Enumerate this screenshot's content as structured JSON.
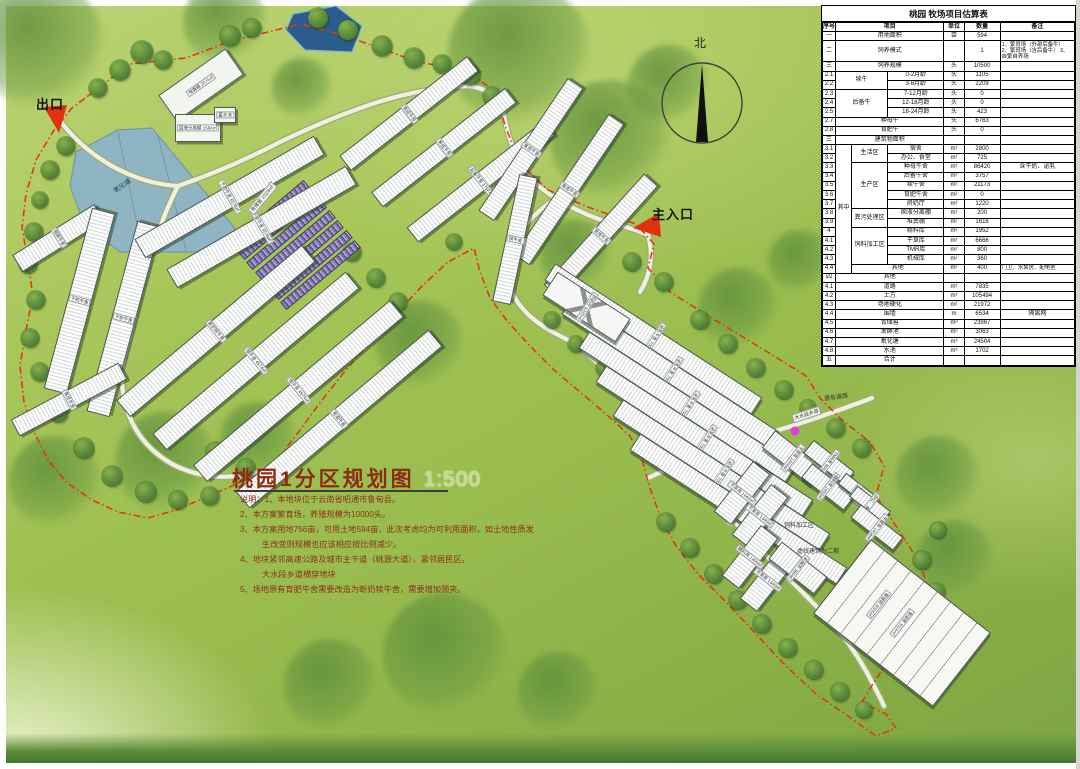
{
  "map": {
    "title": "桃园1分区规划图",
    "scale": "1:500",
    "north": "北",
    "exit": "出口",
    "entrance": "主入口",
    "existing_road": "原有道路",
    "road_name": "大水段乡道",
    "phase2_note": "虚线建筑为二期",
    "feed_zone": "饲料加工区",
    "pond": "氧化塘",
    "silage_tag": "青储窖 2324㎡",
    "notes": [
      "说明：1、本地块位于云南省昭通市鲁甸县。",
      "2、本方案繁育场，养殖规模为10000头。",
      "3、本方案用地756亩，可用土地594亩，此次考虑均为可利用面积，如土地性质发",
      "生改变则规模也应该相应按比例减少。",
      "4、地块紧邻高速公路及城市主干道（桃源大道），紧邻居民区。",
      "大水段乡道横穿地块",
      "5、场地原有育肥牛舍需要改造为断奶犊牛舍，需要增加颈夹。"
    ]
  },
  "buildings": [
    "隔离牛舍",
    "干奶牛舍",
    "干奶牛舍",
    "断奶犊牛舍",
    "犊牛舍 4574㎡",
    "犊牛舍 4574㎡",
    "育成牛舍",
    "干奶牛舍 6576㎡",
    "干奶牛舍 6576㎡",
    "育成牛舍",
    "育成牛舍",
    "育成牛舍",
    "后备牛舍 3757㎡",
    "育成牛舍",
    "育成牛舍",
    "犊牛舍",
    "育成牛舍",
    "泌乳牛舍 7004㎡",
    "泌乳牛舍 7004㎡",
    "泌乳牛舍 7004㎡",
    "泌乳牛舍 7004㎡",
    "泌乳牛舍 7004㎡",
    "泌乳牛舍 7004㎡",
    "挤奶厅 1220㎡",
    "干草库 1404㎡",
    "TMR库 800㎡",
    "精料库 1952㎡",
    "宿舍",
    "办公、食堂",
    "干草库 1404㎡",
    "干草库 1440㎡",
    "干草库 1440㎡",
    "精料库 1400㎡",
    "干草库 1440㎡",
    "机械库 360㎡",
    "堆粪棚 2574㎡",
    "固液分离棚 1584㎡",
    "蓄水池",
    "青储窖 3024㎡"
  ],
  "table": {
    "title": "桃园 牧场项目估算表",
    "rows": [
      {
        "cls": "hd",
        "c": [
          [
            "序号"
          ],
          [
            "项目",
            3
          ],
          [
            "单位"
          ],
          [
            "数量"
          ],
          [
            "备注"
          ]
        ]
      },
      {
        "c": [
          [
            "一"
          ],
          [
            "用地面积",
            3
          ],
          [
            "亩"
          ],
          [
            "594"
          ],
          [
            ""
          ]
        ]
      },
      {
        "cls": "tall",
        "c": [
          [
            "二"
          ],
          [
            "饲养模式",
            3
          ],
          [
            ""
          ],
          [
            "1"
          ],
          [
            "1、繁育场（外部后备牛） 2、繁育场（含后备牛） 3、自繁自养场",
            1,
            1,
            "small"
          ]
        ]
      },
      {
        "c": [
          [
            "三"
          ],
          [
            "饲养规模",
            3
          ],
          [
            "头"
          ],
          [
            "10500"
          ],
          [
            ""
          ]
        ]
      },
      {
        "c": [
          [
            "2.1"
          ],
          [
            "犊牛",
            2,
            2
          ],
          [
            "0-2月龄"
          ],
          [
            "头"
          ],
          [
            "1105"
          ],
          [
            ""
          ]
        ]
      },
      {
        "c": [
          [
            "2.2"
          ],
          [
            "3-6月龄"
          ],
          [
            "头"
          ],
          [
            "2209"
          ],
          [
            ""
          ]
        ]
      },
      {
        "c": [
          [
            "2.3"
          ],
          [
            "后备牛",
            2,
            3
          ],
          [
            "7-12月龄"
          ],
          [
            "头"
          ],
          [
            "0"
          ],
          [
            ""
          ]
        ]
      },
      {
        "c": [
          [
            "2.4"
          ],
          [
            "12-18月龄"
          ],
          [
            "头"
          ],
          [
            "0"
          ],
          [
            ""
          ]
        ]
      },
      {
        "c": [
          [
            "2.5"
          ],
          [
            "18-24月龄"
          ],
          [
            "头"
          ],
          [
            "423"
          ],
          [
            ""
          ]
        ]
      },
      {
        "c": [
          [
            "2.7"
          ],
          [
            "种母牛",
            3
          ],
          [
            "头"
          ],
          [
            "6763"
          ],
          [
            ""
          ]
        ]
      },
      {
        "c": [
          [
            "2.8"
          ],
          [
            "育肥牛",
            3
          ],
          [
            "头"
          ],
          [
            "0"
          ],
          [
            ""
          ]
        ]
      },
      {
        "c": [
          [
            "三"
          ],
          [
            "建筑物面积",
            3
          ],
          [
            ""
          ],
          [
            ""
          ],
          [
            ""
          ]
        ]
      },
      {
        "c": [
          [
            "3.1"
          ],
          [
            "其中",
            1,
            14
          ],
          [
            "生活区",
            1,
            2
          ],
          [
            "宿舍"
          ],
          [
            "m²"
          ],
          [
            "2800"
          ],
          [
            ""
          ]
        ]
      },
      {
        "c": [
          [
            "3.2"
          ],
          [
            "办公、食堂"
          ],
          [
            "m²"
          ],
          [
            "725"
          ],
          [
            ""
          ]
        ]
      },
      {
        "c": [
          [
            "3.3"
          ],
          [
            "生产区",
            1,
            5
          ],
          [
            "种母牛舍"
          ],
          [
            "m²"
          ],
          [
            "86420"
          ],
          [
            "含干奶、泌乳"
          ]
        ]
      },
      {
        "c": [
          [
            "3.4"
          ],
          [
            "后备牛舍"
          ],
          [
            "m²"
          ],
          [
            "3757"
          ],
          [
            ""
          ]
        ]
      },
      {
        "c": [
          [
            "3.5"
          ],
          [
            "犊牛舍"
          ],
          [
            "m²"
          ],
          [
            "21173"
          ],
          [
            ""
          ]
        ]
      },
      {
        "c": [
          [
            "3.6"
          ],
          [
            "育肥牛舍"
          ],
          [
            "m²"
          ],
          [
            "0"
          ],
          [
            ""
          ]
        ]
      },
      {
        "c": [
          [
            "3.7"
          ],
          [
            "挤奶厅"
          ],
          [
            "m²"
          ],
          [
            "1220"
          ],
          [
            ""
          ]
        ]
      },
      {
        "c": [
          [
            "3.8"
          ],
          [
            "粪污处理区",
            1,
            2
          ],
          [
            "固液分离棚"
          ],
          [
            "m²"
          ],
          [
            "200"
          ],
          [
            ""
          ]
        ]
      },
      {
        "c": [
          [
            "3.9"
          ],
          [
            "堆粪棚"
          ],
          [
            "m²"
          ],
          [
            "1616"
          ],
          [
            ""
          ]
        ]
      },
      {
        "c": [
          [
            "4"
          ],
          [
            "饲料加工区",
            1,
            4
          ],
          [
            "精料库"
          ],
          [
            "m²"
          ],
          [
            "1952"
          ],
          [
            ""
          ]
        ]
      },
      {
        "c": [
          [
            "4.1"
          ],
          [
            "干草库"
          ],
          [
            "m²"
          ],
          [
            "6666"
          ],
          [
            ""
          ]
        ]
      },
      {
        "c": [
          [
            "4.2"
          ],
          [
            "TMR库"
          ],
          [
            "m²"
          ],
          [
            "800"
          ],
          [
            ""
          ]
        ]
      },
      {
        "c": [
          [
            "4.3"
          ],
          [
            "机械库"
          ],
          [
            "m²"
          ],
          [
            "360"
          ],
          [
            ""
          ]
        ]
      },
      {
        "c": [
          [
            "4.4"
          ],
          [
            "其他",
            2
          ],
          [
            "m²"
          ],
          [
            "400"
          ],
          [
            "门卫、水泵房、配电室",
            1,
            1,
            "small"
          ]
        ]
      },
      {
        "c": [
          [
            "四"
          ],
          [
            "其他",
            3
          ],
          [
            ""
          ],
          [
            ""
          ],
          [
            ""
          ]
        ]
      },
      {
        "c": [
          [
            "4.1"
          ],
          [
            "道路",
            3
          ],
          [
            "m²"
          ],
          [
            "7835"
          ],
          [
            ""
          ]
        ]
      },
      {
        "c": [
          [
            "4.2"
          ],
          [
            "土方",
            3
          ],
          [
            "m³"
          ],
          [
            "105494"
          ],
          [
            ""
          ]
        ]
      },
      {
        "c": [
          [
            "4.3"
          ],
          [
            "场地硬化",
            3
          ],
          [
            "m²"
          ],
          [
            "21972"
          ],
          [
            ""
          ]
        ]
      },
      {
        "c": [
          [
            "4.4"
          ],
          [
            "围墙",
            3
          ],
          [
            "m"
          ],
          [
            "6534"
          ],
          [
            "隔离网"
          ]
        ]
      },
      {
        "c": [
          [
            "4.5"
          ],
          [
            "青储窖",
            3
          ],
          [
            "m³"
          ],
          [
            "23967"
          ],
          [
            ""
          ]
        ]
      },
      {
        "c": [
          [
            "4.6"
          ],
          [
            "发酵池",
            3
          ],
          [
            "m³"
          ],
          [
            "3063"
          ],
          [
            ""
          ]
        ]
      },
      {
        "c": [
          [
            "4.7"
          ],
          [
            "氧化塘",
            3
          ],
          [
            "m³"
          ],
          [
            "24504"
          ],
          [
            ""
          ]
        ]
      },
      {
        "c": [
          [
            "4.8"
          ],
          [
            "水池",
            3
          ],
          [
            "m³"
          ],
          [
            "1702"
          ],
          [
            ""
          ]
        ]
      },
      {
        "c": [
          [
            "五"
          ],
          [
            "合计",
            3
          ],
          [
            ""
          ],
          [
            ""
          ],
          [
            ""
          ]
        ]
      }
    ]
  }
}
